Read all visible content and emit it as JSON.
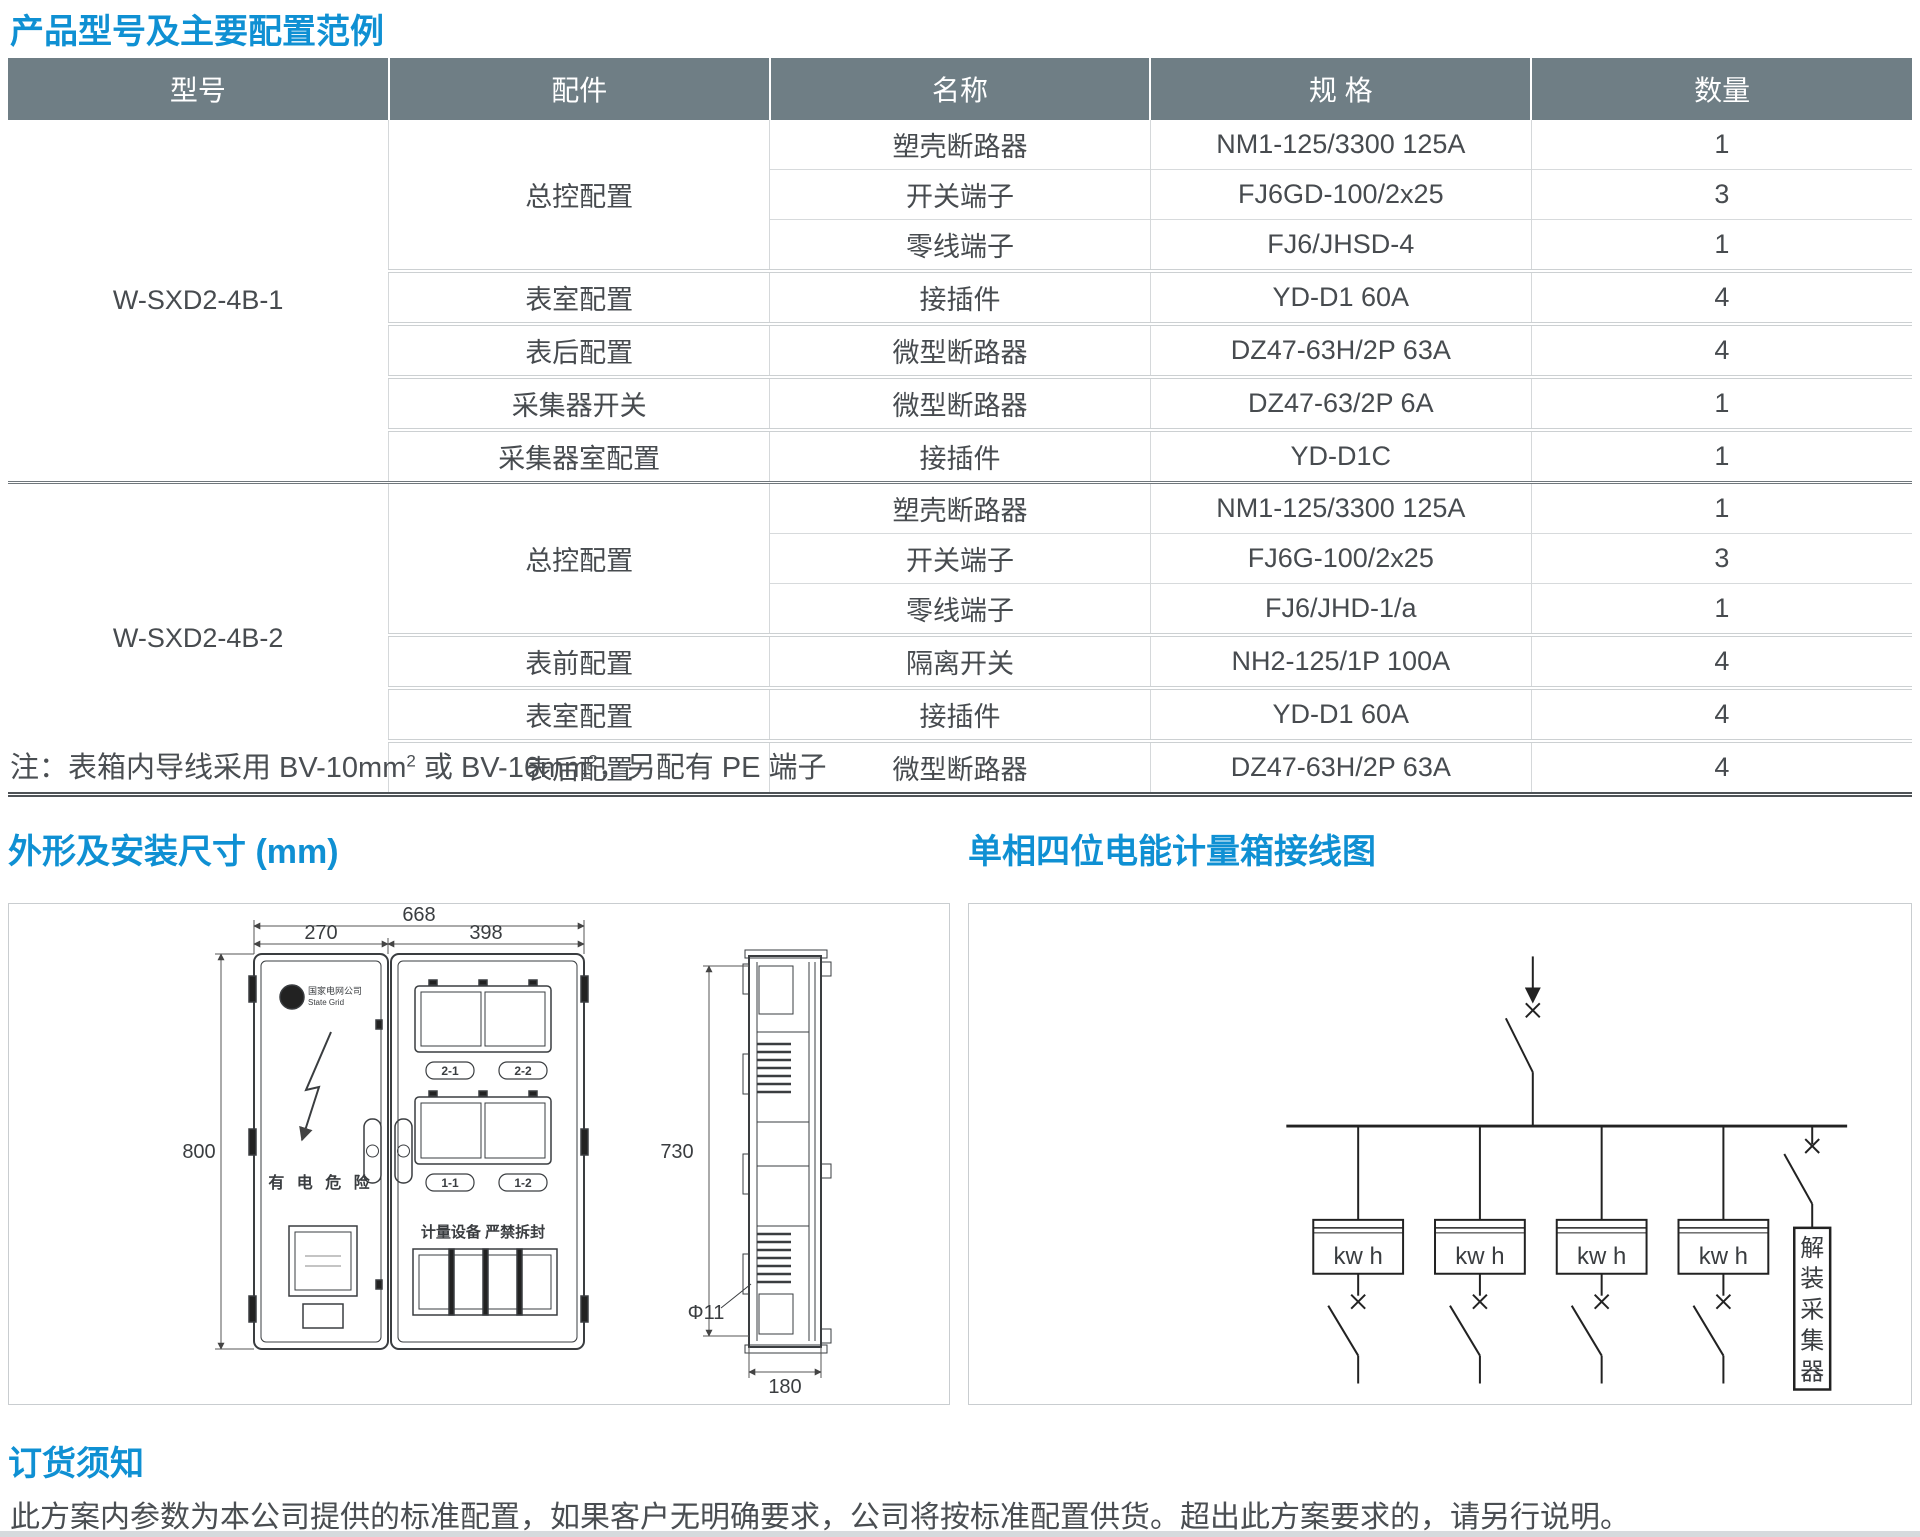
{
  "page": {
    "title": "产品型号及主要配置范例",
    "note": {
      "p1": "注：表箱内导线采用 BV-10mm",
      "s1": "2",
      "p2": " 或 BV-16mm",
      "s2": "2",
      "p3": "，另配有 PE 端子"
    },
    "colors": {
      "accent_blue": "#0f90d3",
      "header_gray": "#6f7e85"
    }
  },
  "table": {
    "headers": [
      "型号",
      "配件",
      "名称",
      "规 格",
      "数量"
    ],
    "groups": [
      {
        "model": "W-SXD2-4B-1",
        "rows": [
          {
            "part": "总控配置",
            "name": "塑壳断路器",
            "spec": "NM1-125/3300 125A",
            "qty": "1"
          },
          {
            "name": "开关端子",
            "spec": "FJ6GD-100/2x25",
            "qty": "3"
          },
          {
            "name": "零线端子",
            "spec": "FJ6/JHSD-4",
            "qty": "1"
          },
          {
            "part": "表室配置",
            "name": "接插件",
            "spec": "YD-D1 60A",
            "qty": "4"
          },
          {
            "part": "表后配置",
            "name": "微型断路器",
            "spec": "DZ47-63H/2P 63A",
            "qty": "4"
          },
          {
            "part": "采集器开关",
            "name": "微型断路器",
            "spec": "DZ47-63/2P 6A",
            "qty": "1"
          },
          {
            "part": "采集器室配置",
            "name": "接插件",
            "spec": "YD-D1C",
            "qty": "1"
          }
        ]
      },
      {
        "model": "W-SXD2-4B-2",
        "rows": [
          {
            "part": "总控配置",
            "name": "塑壳断路器",
            "spec": "NM1-125/3300 125A",
            "qty": "1"
          },
          {
            "name": "开关端子",
            "spec": "FJ6G-100/2x25",
            "qty": "3"
          },
          {
            "name": "零线端子",
            "spec": "FJ6/JHD-1/a",
            "qty": "1"
          },
          {
            "part": "表前配置",
            "name": "隔离开关",
            "spec": "NH2-125/1P 100A",
            "qty": "4"
          },
          {
            "part": "表室配置",
            "name": "接插件",
            "spec": "YD-D1 60A",
            "qty": "4"
          },
          {
            "part": "表后配置",
            "name": "微型断路器",
            "spec": "DZ47-63H/2P 63A",
            "qty": "4"
          }
        ]
      }
    ]
  },
  "dimensions_section": {
    "title": "外形及安装尺寸 (mm)",
    "front_view": {
      "dim_total_width": "668",
      "dim_left_width": "270",
      "dim_right_width": "398",
      "dim_height": "800",
      "logo_line1": "国家电网公司",
      "logo_line2": "State Grid",
      "door_warning": "有 电 危 险",
      "meter_labels": [
        "2-1",
        "2-2",
        "1-1",
        "1-2"
      ],
      "seal_text": "计量设备 严禁拆封"
    },
    "side_view": {
      "dim_height": "730",
      "dim_depth": "180",
      "dim_hole": "Φ11"
    }
  },
  "wiring_section": {
    "title": "单相四位电能计量箱接线图",
    "meter_label": "kw h",
    "collector_label": "解装采集器",
    "collector_chars": [
      "解",
      "装",
      "采",
      "集",
      "器"
    ]
  },
  "ordering_section": {
    "title": "订货须知",
    "body": "此方案内参数为本公司提供的标准配置，如果客户无明确要求，公司将按标准配置供货。超出此方案要求的，请另行说明。"
  }
}
